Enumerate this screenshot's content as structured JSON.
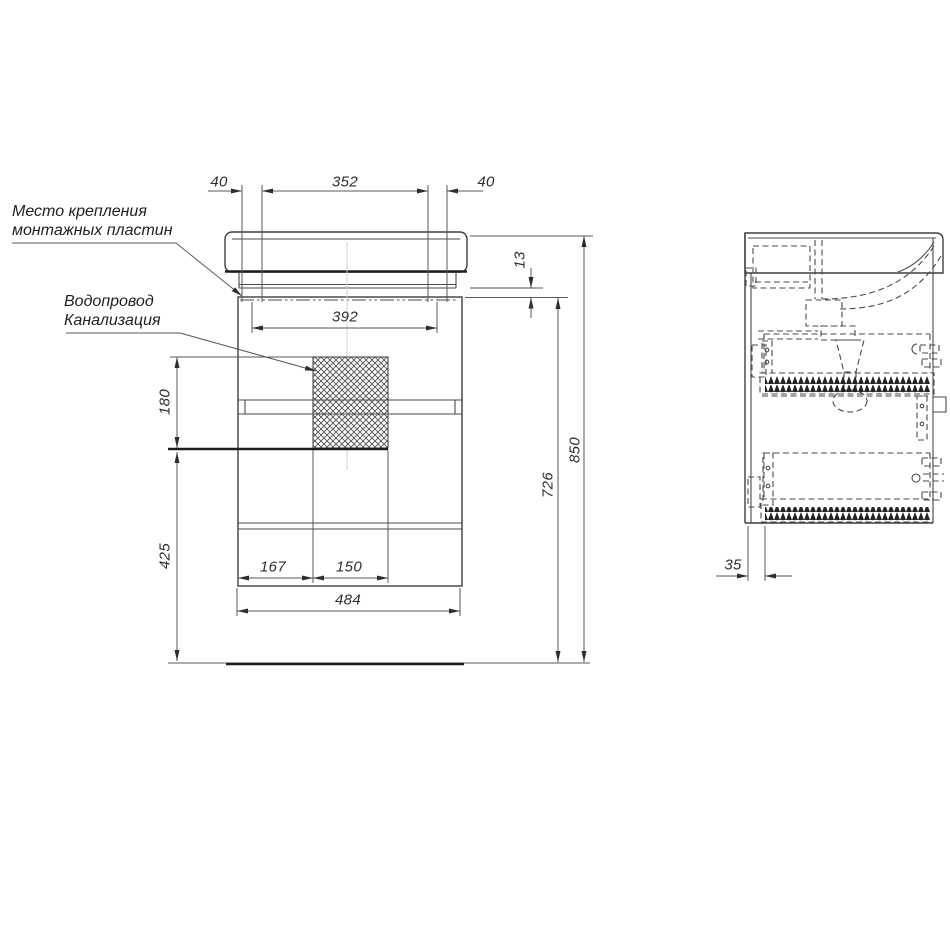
{
  "annotations": {
    "mounting_plates": {
      "line1": "Место крепления",
      "line2": "монтажных пластин"
    },
    "plumbing": {
      "line1": "Водопровод",
      "line2": "Канализация"
    }
  },
  "dimensions": {
    "front": {
      "mount_offset_left": "40",
      "mount_span": "352",
      "mount_offset_right": "40",
      "mount_plate_drop": "13",
      "mount_width": "392",
      "service_zone_height": "180",
      "service_zone_floor_height": "425",
      "service_zone_offset": "167",
      "service_zone_width": "150",
      "cabinet_width": "484",
      "underside_height": "726",
      "overall_height": "850"
    },
    "side": {
      "back_panel_offset": "35"
    }
  },
  "colors": {
    "background": "#ffffff",
    "line": "#474747",
    "thick_line": "#1e1e1e",
    "center_line": "#cfcfcf",
    "text": "#2e2e2e"
  }
}
